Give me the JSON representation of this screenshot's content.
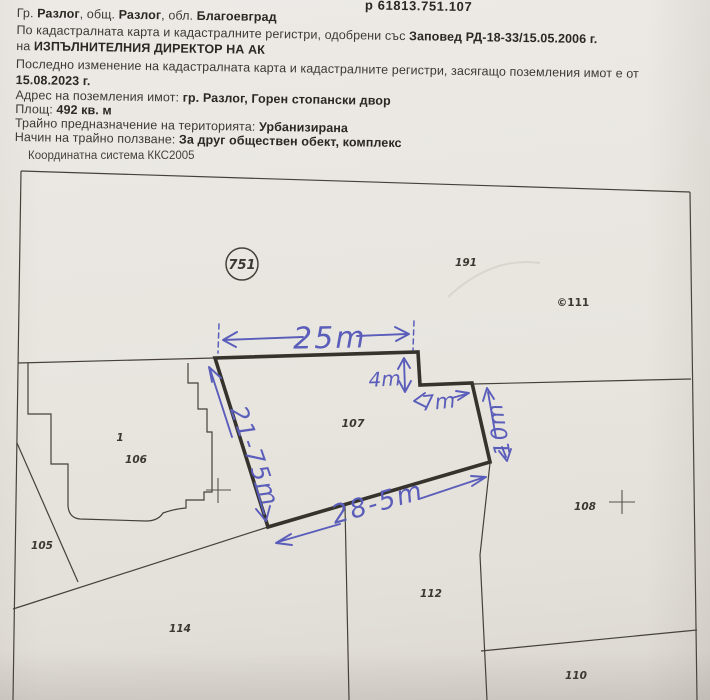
{
  "document": {
    "id_fragment": "р 61813.751.107",
    "line1": {
      "p1": "Гр. ",
      "p2": "Разлог",
      "p3": ", общ. ",
      "p4": "Разлог",
      "p5": ", обл. ",
      "p6": "Благоевград"
    },
    "line2": {
      "p1": "По кадастралната карта и кадастралните регистри, одобрени със ",
      "p2": "Заповед РД-18-33/15.05.2006 г."
    },
    "line3": {
      "p1": "на ",
      "p2": "ИЗПЪЛНИТЕЛНИЯ ДИРЕКТОР НА АК"
    },
    "line4": {
      "p1": "Последно изменение на кадастралната карта и кадастралните регистри, засягащо поземления имот е от"
    },
    "line5": {
      "p1": "15.08.2023 г."
    },
    "line6": {
      "p1": "Адрес на поземления имот: ",
      "p2": "гр. Разлог, Горен стопански двор"
    },
    "line7": {
      "p1": "Площ: ",
      "p2": "492 кв. м"
    },
    "line8": {
      "p1": "Трайно предназначение на територията: ",
      "p2": "Урбанизирана"
    },
    "line9": {
      "p1": "Начин на трайно ползване: ",
      "p2": "За друг обществен обект, комплекс"
    }
  },
  "map": {
    "coordinate_system": "Координатна система ККС2005",
    "region_number": "751",
    "parcel_labels": {
      "p191": "191",
      "p111": "©111",
      "p107": "107",
      "p1": "1",
      "p106": "106",
      "p105": "105",
      "p114": "114",
      "p112": "112",
      "p108": "108",
      "p110": "110"
    },
    "annotations": {
      "top_width": "25m",
      "notch_depth": "4m",
      "notch_width": "7m",
      "west_side": "21-75m",
      "south_side": "28-5m",
      "east_side": "10m"
    }
  },
  "colors": {
    "ink_blue": "#5a5eba",
    "map_line": "#45413a",
    "parcel_outline": "#36332d",
    "paper": "#e9e6e1"
  }
}
